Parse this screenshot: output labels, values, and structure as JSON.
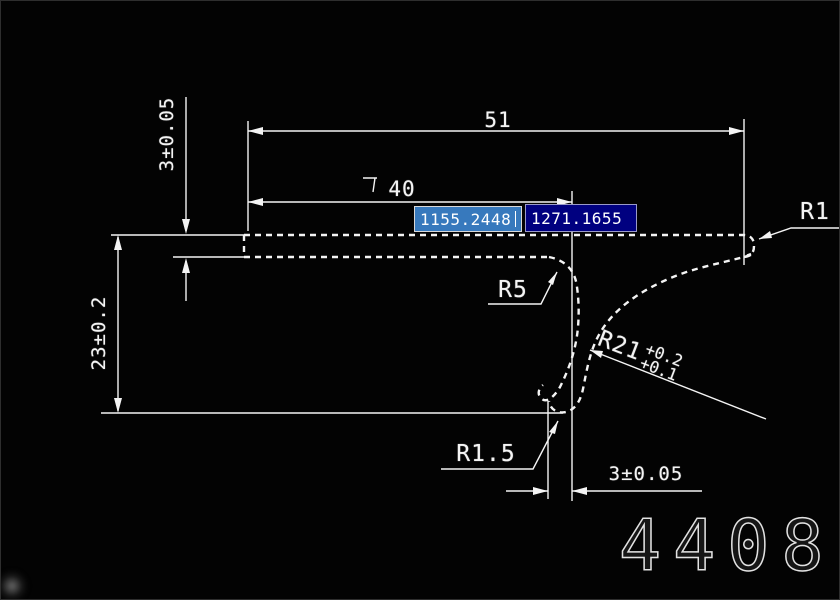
{
  "app": {
    "background_color": "#030303",
    "line_color": "#ffffff"
  },
  "drawing": {
    "dimensions": {
      "top_width": "51",
      "inner_width": "40",
      "strip_thickness": "3±0.05",
      "overall_height": "23±0.2",
      "hook_offset": "3±0.05"
    },
    "radii": {
      "end_radius": "R1",
      "bend_radius": "R5",
      "hook_radius": "R1.5",
      "sweep_radius": "R21",
      "sweep_tol_upper": "+0.2",
      "sweep_tol_lower": "+0.1"
    },
    "part_number": "4408"
  },
  "dynamic_input": {
    "x_value": "1155.2448",
    "y_value": "1271.1655",
    "x_field_bg": "#3779bd",
    "y_field_bg": "#000080"
  }
}
